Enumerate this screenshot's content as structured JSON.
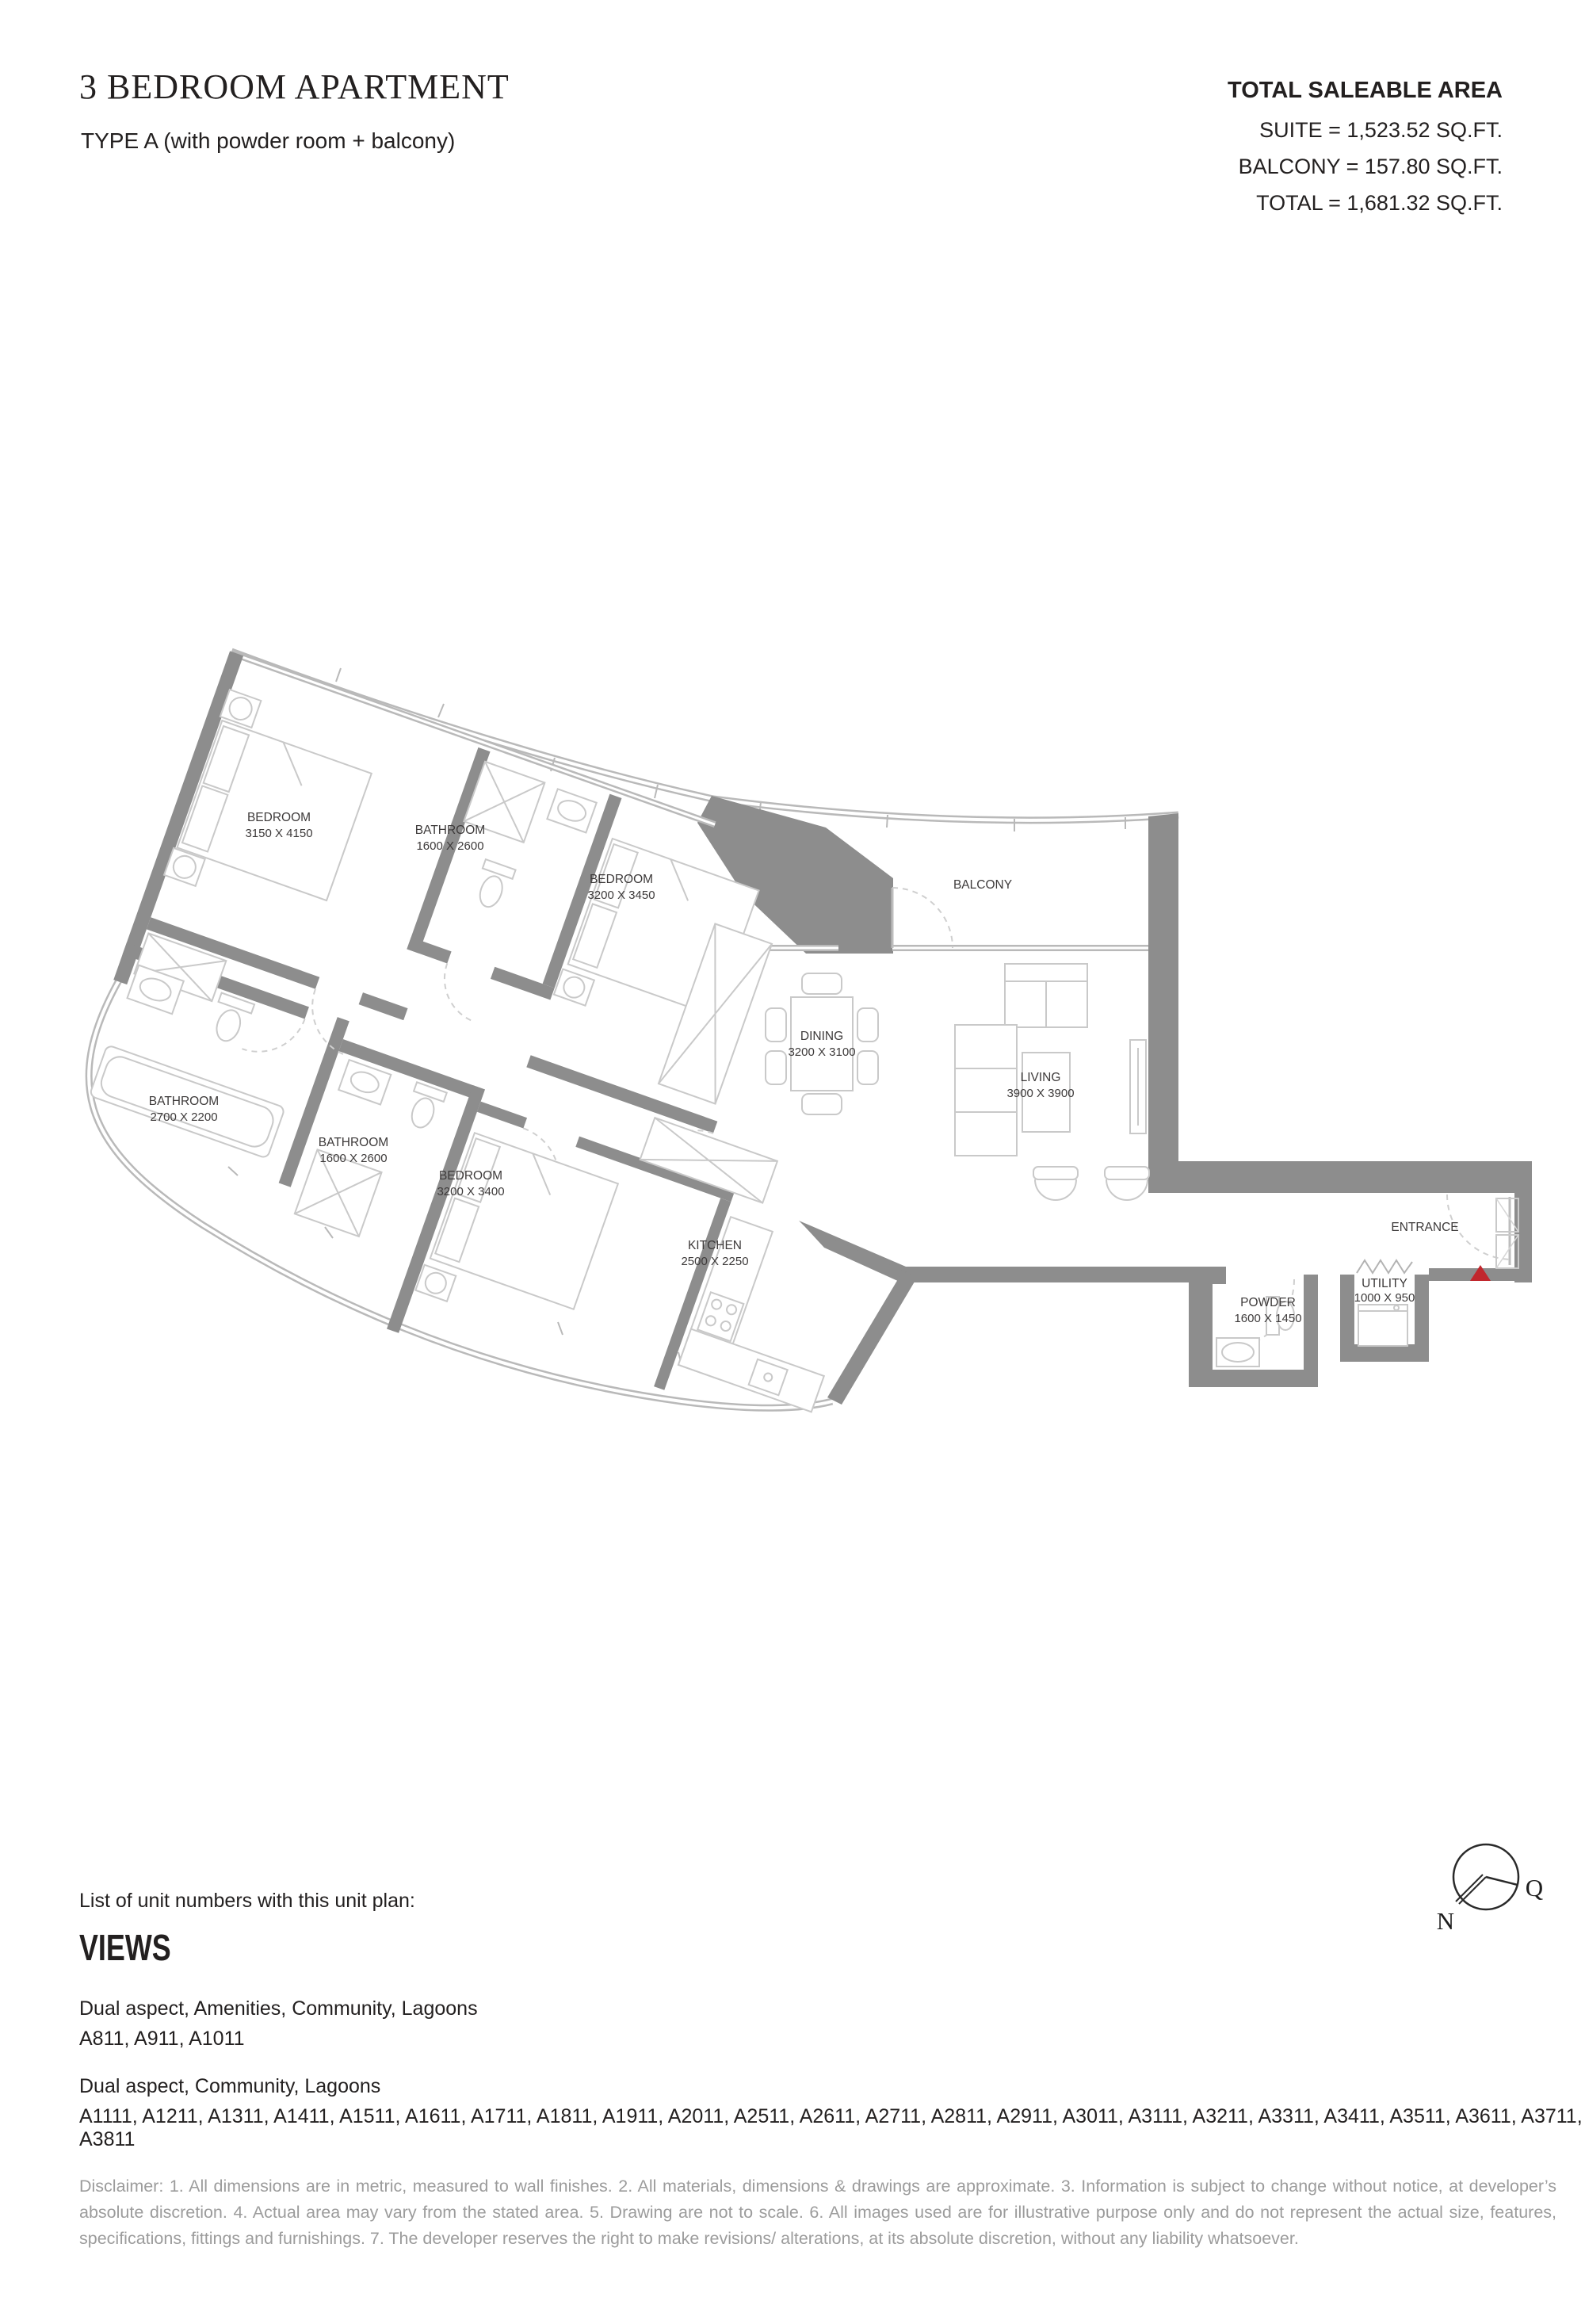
{
  "header": {
    "title": "3 BEDROOM APARTMENT",
    "subtitle": "TYPE A (with powder room + balcony)",
    "area": {
      "heading": "TOTAL SALEABLE AREA",
      "suite": "SUITE = 1,523.52 SQ.FT.",
      "balcony": "BALCONY = 157.80 SQ.FT.",
      "total": "TOTAL = 1,681.32 SQ.FT."
    }
  },
  "plan": {
    "rooms": [
      {
        "name": "BEDROOM",
        "dims": "3150 X 4150"
      },
      {
        "name": "BATHROOM",
        "dims": "1600 X 2600"
      },
      {
        "name": "BEDROOM",
        "dims": "3200 X 3450"
      },
      {
        "name": "BALCONY",
        "dims": ""
      },
      {
        "name": "DINING",
        "dims": "3200 X 3100"
      },
      {
        "name": "LIVING",
        "dims": "3900 X 3900"
      },
      {
        "name": "BATHROOM",
        "dims": "2700 X 2200"
      },
      {
        "name": "BATHROOM",
        "dims": "1600 X 2600"
      },
      {
        "name": "BEDROOM",
        "dims": "3200 X 3400"
      },
      {
        "name": "KITCHEN",
        "dims": "2500 X 2250"
      },
      {
        "name": "ENTRANCE",
        "dims": ""
      },
      {
        "name": "POWDER",
        "dims": "1600 X 1450"
      },
      {
        "name": "UTILITY",
        "dims": "1000 X 950"
      }
    ]
  },
  "compass": {
    "north_label": "N",
    "q_label": "Q"
  },
  "footer": {
    "list_label": "List of unit numbers with this unit plan:",
    "views_heading": "VIEWS",
    "groups": [
      {
        "view": "Dual aspect, Amenities, Community, Lagoons",
        "units": "A811, A911, A1011"
      },
      {
        "view": "Dual aspect, Community, Lagoons",
        "units": "A1111, A1211, A1311, A1411, A1511, A1611, A1711, A1811, A1911, A2011, A2511, A2611, A2711, A2811, A2911, A3011, A3111, A3211, A3311, A3411, A3511, A3611, A3711, A3811"
      }
    ],
    "disclaimer": "Disclaimer: 1. All dimensions are in metric, measured to wall finishes. 2. All materials, dimensions & drawings are approximate. 3. Information is subject to change without notice, at developer’s absolute discretion. 4. Actual area may vary from the stated area. 5. Drawing are not to scale. 6. All images used are for illustrative purpose only and do not represent the actual size, features, specifications, fittings and furnishings. 7. The developer reserves the right to make revisions/ alterations, at its absolute discretion, without any liability whatsoever."
  },
  "colors": {
    "wall": "#8d8d8d",
    "thin_line": "#b9b9b9",
    "furniture": "#c9c9c9",
    "accent_red": "#c1272d",
    "text_dark": "#232020",
    "text_gray": "#9c9c9c"
  }
}
